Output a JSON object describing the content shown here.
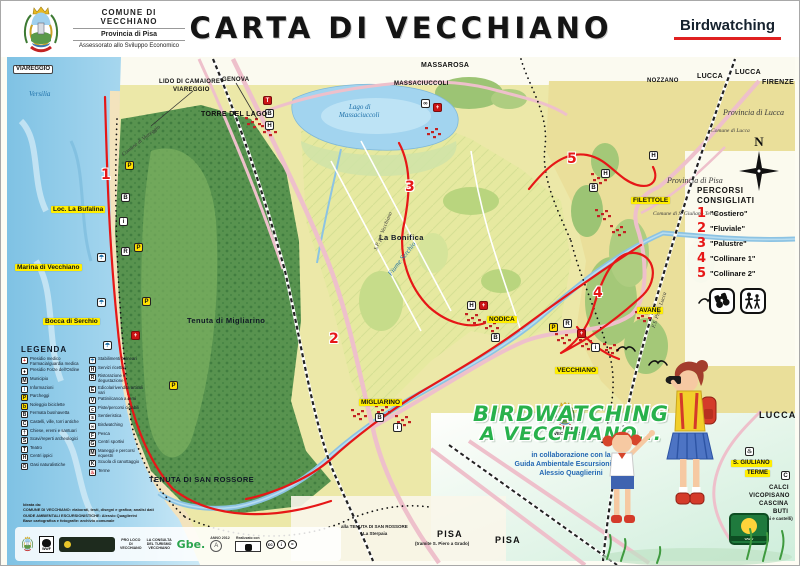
{
  "colors": {
    "accent_red": "#e61717",
    "highlight_yellow": "#ffee00",
    "promo_green": "#28b14c",
    "credit_blue": "#2468b3",
    "sea": "#8ecbe8",
    "forest": "#58934f"
  },
  "header": {
    "org": "COMUNE DI VECCHIANO",
    "org_sub1": "Provincia di Pisa",
    "org_sub2": "Assessorato allo Sviluppo Economico",
    "title": "CARTA DI VECCHIANO",
    "topic": "Birdwatching"
  },
  "compass": {
    "n": "N"
  },
  "routes_panel": {
    "title_line1": "PERCORSI",
    "title_line2": "CONSIGLIATI",
    "items": [
      {
        "num": "1",
        "label": "\"Costiero\""
      },
      {
        "num": "2",
        "label": "\"Fluviale\""
      },
      {
        "num": "3",
        "label": "\"Palustre\""
      },
      {
        "num": "4",
        "label": "\"Collinare 1\""
      },
      {
        "num": "5",
        "label": "\"Collinare 2\""
      }
    ]
  },
  "legend": {
    "title": "LEGENDA",
    "col1": [
      {
        "g": "+",
        "v": "rc",
        "label": "Presidio medico Farmacia/guardia medica"
      },
      {
        "g": "♦",
        "v": "w",
        "label": "Presidio Forze dell'Ordine"
      },
      {
        "g": "M",
        "v": "w",
        "label": "Municipio"
      },
      {
        "g": "i",
        "v": "b",
        "label": "Informazioni"
      },
      {
        "g": "P",
        "v": "y",
        "label": "Parcheggi"
      },
      {
        "g": "b",
        "v": "y",
        "label": "Noleggio biciclette"
      },
      {
        "g": "B",
        "v": "w",
        "label": "Fermata bus/navetta"
      },
      {
        "g": "C",
        "v": "w",
        "label": "Castelli, ville, torri antiche"
      },
      {
        "g": "†",
        "v": "w",
        "label": "Chiese, eremi e santuari"
      },
      {
        "g": "S",
        "v": "w",
        "label": "Scavi/reperti archeologici"
      },
      {
        "g": "T",
        "v": "w",
        "label": "Teatro"
      },
      {
        "g": "H",
        "v": "w",
        "label": "Centri ippici"
      },
      {
        "g": "O",
        "v": "w",
        "label": "Oasi naturalistiche"
      }
    ],
    "col2": [
      {
        "g": "☂",
        "v": "b",
        "label": "Stabilimenti balneari"
      },
      {
        "g": "H",
        "v": "w",
        "label": "Servizi ricettivi"
      },
      {
        "g": "R",
        "v": "w",
        "label": "Ristorazione e degustazione"
      },
      {
        "g": "E",
        "v": "w",
        "label": "Edicola/rivendita articoli vari"
      },
      {
        "g": "V",
        "v": "w",
        "label": "Pattini/canoa a remi"
      },
      {
        "g": "c",
        "v": "w",
        "label": "Piste/percorsi ciclabili"
      },
      {
        "g": "s",
        "v": "w",
        "label": "Sentieristica"
      },
      {
        "g": "∞",
        "v": "w",
        "label": "Birdwatching"
      },
      {
        "g": "F",
        "v": "w",
        "label": "Pesca"
      },
      {
        "g": "G",
        "v": "w",
        "label": "Centri sportivi"
      },
      {
        "g": "M",
        "v": "w",
        "label": "Maneggi e percorsi equestri"
      },
      {
        "g": "K",
        "v": "w",
        "label": "Scuola di canottaggio"
      },
      {
        "g": "♨",
        "v": "rc",
        "label": "Terme"
      }
    ]
  },
  "map": {
    "labels": [
      {
        "text": "VIAREGGIO",
        "x": 12,
        "y": 64,
        "cls": "box"
      },
      {
        "text": "Versilia",
        "x": 28,
        "y": 90,
        "cls": "water"
      },
      {
        "text": "LIDO DI CAMAIORE",
        "x": 158,
        "y": 78,
        "cls": "dest sm"
      },
      {
        "text": "VIAREGGIO",
        "x": 172,
        "y": 86,
        "cls": "dest sm"
      },
      {
        "text": "GENOVA",
        "x": 221,
        "y": 76,
        "cls": "dest sm"
      },
      {
        "text": "TORRE DEL LAGO",
        "x": 200,
        "y": 110,
        "cls": "dest"
      },
      {
        "text": "MASSAROSA",
        "x": 420,
        "y": 61,
        "cls": "dest"
      },
      {
        "text": "MASSACIUCCOLI",
        "x": 393,
        "y": 80,
        "cls": "dest sm"
      },
      {
        "text": "Lago di",
        "x": 348,
        "y": 103,
        "cls": "water"
      },
      {
        "text": "Massaciuccoli",
        "x": 338,
        "y": 111,
        "cls": "water"
      },
      {
        "text": "NOZZANO",
        "x": 646,
        "y": 77,
        "cls": "dest sm"
      },
      {
        "text": "LUCCA",
        "x": 696,
        "y": 72,
        "cls": "dest"
      },
      {
        "text": "LUCCA",
        "x": 734,
        "y": 68,
        "cls": "dest"
      },
      {
        "text": "FIRENZE",
        "x": 761,
        "y": 78,
        "cls": "dest"
      },
      {
        "text": "Provincia di Lucca",
        "x": 722,
        "y": 108,
        "cls": "prov"
      },
      {
        "text": "Comune di Lucca",
        "x": 710,
        "y": 127,
        "cls": "prov tiny2"
      },
      {
        "text": "Provincia di Pisa",
        "x": 666,
        "y": 176,
        "cls": "prov"
      },
      {
        "text": "Comune di Viareggio",
        "x": 120,
        "y": 152,
        "cls": "prov tiny2",
        "rot": -38
      },
      {
        "text": "Comune di S. Giuliano Terme",
        "x": 652,
        "y": 210,
        "cls": "prov tiny2"
      },
      {
        "text": "Loc. La Bufalina",
        "x": 50,
        "y": 205,
        "cls": "yellow"
      },
      {
        "text": "Marina di Vecchiano",
        "x": 14,
        "y": 263,
        "cls": "yellow"
      },
      {
        "text": "Bocca di Serchio",
        "x": 42,
        "y": 317,
        "cls": "yellow"
      },
      {
        "text": "La Bonifica",
        "x": 378,
        "y": 233,
        "cls": "area"
      },
      {
        "text": "Tenuta di Migliarino",
        "x": 186,
        "y": 316,
        "cls": "area sm"
      },
      {
        "text": "FILETTOLE",
        "x": 630,
        "y": 196,
        "cls": "yellow"
      },
      {
        "text": "AVANE",
        "x": 636,
        "y": 306,
        "cls": "yellow"
      },
      {
        "text": "NODICA",
        "x": 486,
        "y": 315,
        "cls": "yellow"
      },
      {
        "text": "VECCHIANO",
        "x": 554,
        "y": 366,
        "cls": "yellow"
      },
      {
        "text": "MIGLIARINO",
        "x": 358,
        "y": 398,
        "cls": "yellow"
      },
      {
        "text": "TENUTA DI SAN ROSSORE",
        "x": 148,
        "y": 475,
        "cls": "area"
      },
      {
        "text": "Fiume Serchio",
        "x": 386,
        "y": 272,
        "cls": "water",
        "rot": -52
      },
      {
        "text": "S.P. per Vecchiano",
        "x": 372,
        "y": 248,
        "cls": "prov tiny2",
        "rot": -68
      },
      {
        "text": "F.S. Pisa - Lucca",
        "x": 650,
        "y": 326,
        "cls": "prov tiny2",
        "rot": -72
      },
      {
        "text": "PISA",
        "x": 436,
        "y": 529,
        "cls": "city"
      },
      {
        "text": "(tramite S. Piero a Grado)",
        "x": 414,
        "y": 541,
        "cls": "tinynote"
      },
      {
        "text": "PISA",
        "x": 494,
        "y": 535,
        "cls": "city"
      },
      {
        "text": "alla TENUTA DI SAN ROSSORE",
        "x": 340,
        "y": 524,
        "cls": "tinynote"
      },
      {
        "text": "La Sterpaia",
        "x": 362,
        "y": 531,
        "cls": "tinynote"
      },
      {
        "text": "LUCCA",
        "x": 758,
        "y": 410,
        "cls": "city"
      },
      {
        "text": "S. GIULIANO",
        "x": 730,
        "y": 459,
        "cls": "yellow sm2"
      },
      {
        "text": "TERME",
        "x": 744,
        "y": 469,
        "cls": "yellow sm2"
      },
      {
        "text": "CALCI",
        "x": 768,
        "y": 484,
        "cls": "dest sm"
      },
      {
        "text": "VICOPISANO",
        "x": 748,
        "y": 492,
        "cls": "dest sm"
      },
      {
        "text": "CASCINA",
        "x": 758,
        "y": 500,
        "cls": "dest sm"
      },
      {
        "text": "BUTI",
        "x": 772,
        "y": 508,
        "cls": "dest sm"
      },
      {
        "text": "(Antichi borghi e castelli)",
        "x": 738,
        "y": 516,
        "cls": "tinynote"
      },
      {
        "text": "COMUNE DI\nVECCHIANO",
        "x": 553,
        "y": 426,
        "cls": "tinynote"
      }
    ],
    "route_markers": [
      {
        "num": "1",
        "x": 100,
        "y": 166
      },
      {
        "num": "2",
        "x": 328,
        "y": 330
      },
      {
        "num": "3",
        "x": 404,
        "y": 178
      },
      {
        "num": "4",
        "x": 592,
        "y": 284
      },
      {
        "num": "5",
        "x": 566,
        "y": 150
      }
    ],
    "icons": [
      {
        "g": "P",
        "v": "y",
        "x": 124,
        "y": 160
      },
      {
        "g": "P",
        "v": "y",
        "x": 133,
        "y": 242
      },
      {
        "g": "P",
        "v": "y",
        "x": 141,
        "y": 296
      },
      {
        "g": "P",
        "v": "y",
        "x": 168,
        "y": 380
      },
      {
        "g": "☂",
        "v": "b",
        "x": 96,
        "y": 252
      },
      {
        "g": "☂",
        "v": "b",
        "x": 96,
        "y": 297
      },
      {
        "g": "☂",
        "v": "b",
        "x": 102,
        "y": 340
      },
      {
        "g": "i",
        "v": "w",
        "x": 118,
        "y": 216
      },
      {
        "g": "B",
        "v": "w",
        "x": 120,
        "y": 192
      },
      {
        "g": "+",
        "v": "r",
        "x": 130,
        "y": 330
      },
      {
        "g": "R",
        "v": "w",
        "x": 120,
        "y": 246
      },
      {
        "g": "T",
        "v": "r",
        "x": 262,
        "y": 95
      },
      {
        "g": "B",
        "v": "w",
        "x": 264,
        "y": 108
      },
      {
        "g": "H",
        "v": "w",
        "x": 264,
        "y": 120
      },
      {
        "g": "∞",
        "v": "w",
        "x": 420,
        "y": 98
      },
      {
        "g": "+",
        "v": "r",
        "x": 432,
        "y": 102
      },
      {
        "g": "+",
        "v": "r",
        "x": 576,
        "y": 328
      },
      {
        "g": "i",
        "v": "w",
        "x": 590,
        "y": 342
      },
      {
        "g": "R",
        "v": "w",
        "x": 562,
        "y": 318
      },
      {
        "g": "P",
        "v": "y",
        "x": 548,
        "y": 322
      },
      {
        "g": "+",
        "v": "r",
        "x": 478,
        "y": 300
      },
      {
        "g": "H",
        "v": "w",
        "x": 466,
        "y": 300
      },
      {
        "g": "B",
        "v": "w",
        "x": 490,
        "y": 332
      },
      {
        "g": "H",
        "v": "w",
        "x": 600,
        "y": 168
      },
      {
        "g": "B",
        "v": "w",
        "x": 588,
        "y": 182
      },
      {
        "g": "i",
        "v": "w",
        "x": 392,
        "y": 422
      },
      {
        "g": "B",
        "v": "w",
        "x": 374,
        "y": 412
      },
      {
        "g": "H",
        "v": "w",
        "x": 648,
        "y": 150
      },
      {
        "g": "♨",
        "v": "w",
        "x": 744,
        "y": 446
      },
      {
        "g": "C",
        "v": "w",
        "x": 780,
        "y": 470
      }
    ]
  },
  "promo": {
    "line1": "BIRDWATCHING",
    "line2": "A VECCHIANO...",
    "credit1": "in collaborazione con la",
    "credit2": "Guida Ambientale Escursionistica",
    "credit3": "Alessio Quaglierini"
  },
  "footer": {
    "credits": [
      "Ideata da:",
      "COMUNE DI VECCHIANO: elaborati, testi, disegni e grafica; analisi dati",
      "GUIDE AMBIENTALI ESCURSIONISTICHE: Alessio Quaglierini",
      "Base cartografica e fotografie: archivio comunale"
    ],
    "wwf": "WWF",
    "proloco": "PRO LOCO\nDI\nVECCHIANO",
    "consulta": "LA CONSULTA\nDEL TURISMO\nVECCHIANO",
    "gbe": "Gbe.",
    "anno": "ANNO 2012",
    "stamp": "A",
    "realizzato": "Realizzato con",
    "cc_icons": [
      "cc",
      "i",
      "="
    ],
    "website": "www"
  }
}
